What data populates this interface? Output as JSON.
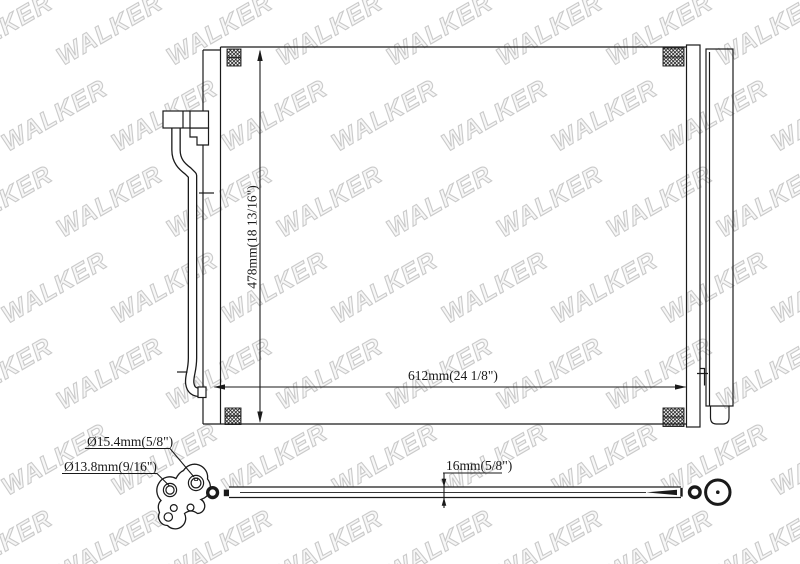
{
  "watermark": {
    "text": "WALKER",
    "outline_color": "#cacaca"
  },
  "colors": {
    "line": "#1a1a1a",
    "background": "#ffffff"
  },
  "labels": {
    "height": "478mm(18 13/16\")",
    "width": "612mm(24 1/8\")",
    "port_large_diameter": "Ø15.4mm(5/8\")",
    "port_small_diameter": "Ø13.8mm(9/16\")",
    "tube_diameter": "16mm(5/8\")"
  }
}
